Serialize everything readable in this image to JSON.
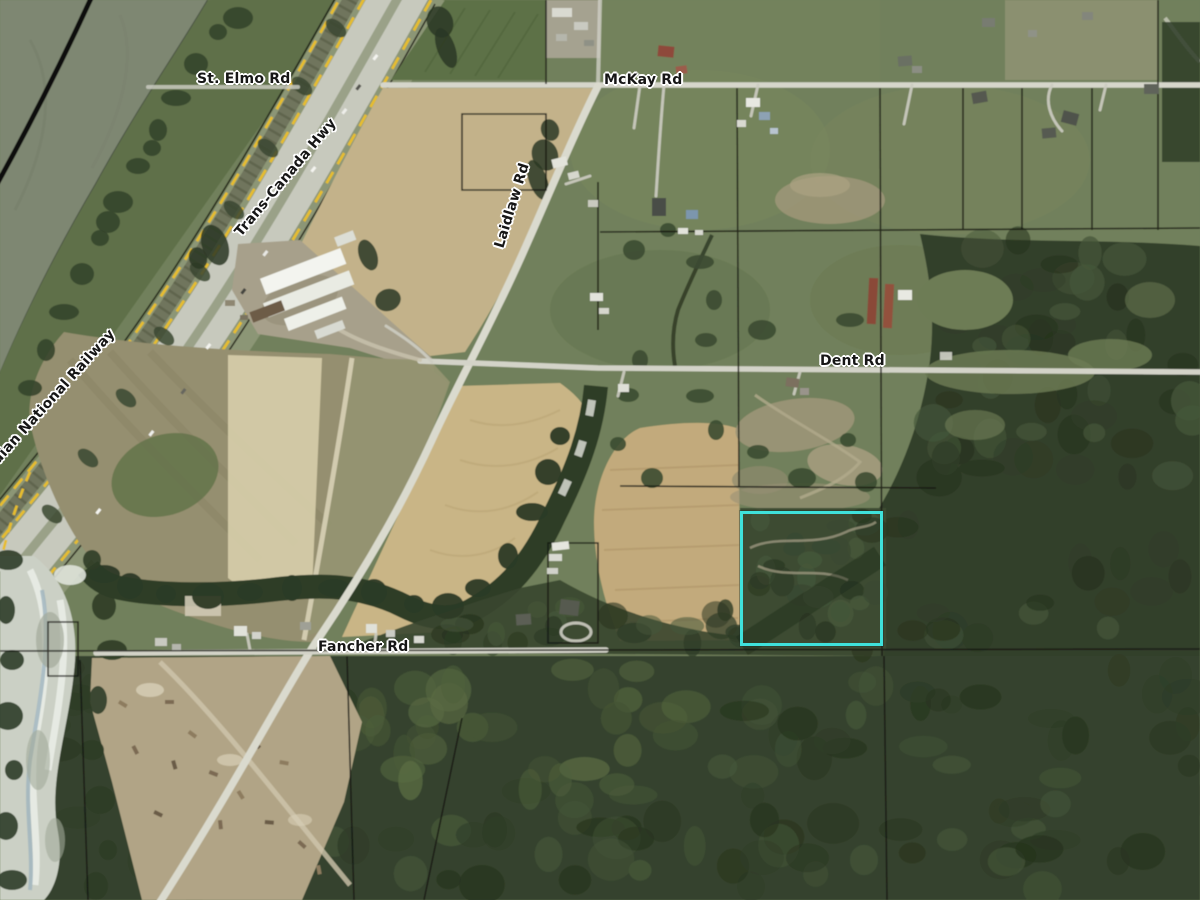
{
  "map": {
    "type": "aerial-parcel-view",
    "road_labels": {
      "st_elmo": "St. Elmo Rd",
      "mckay": "McKay Rd",
      "trans_canada": "Trans-Canada Hwy",
      "cn_railway": "Canadian National Railway",
      "laidlaw": "Laidlaw Rd",
      "dent": "Dent Rd",
      "fancher": "Fancher Rd"
    },
    "subject_parcel": {
      "outline_color": "#3FE1DB"
    },
    "boundary_colors": {
      "municipal_dash_yellow": "#E6BD2F",
      "parcel_line_black": "#141410"
    }
  }
}
